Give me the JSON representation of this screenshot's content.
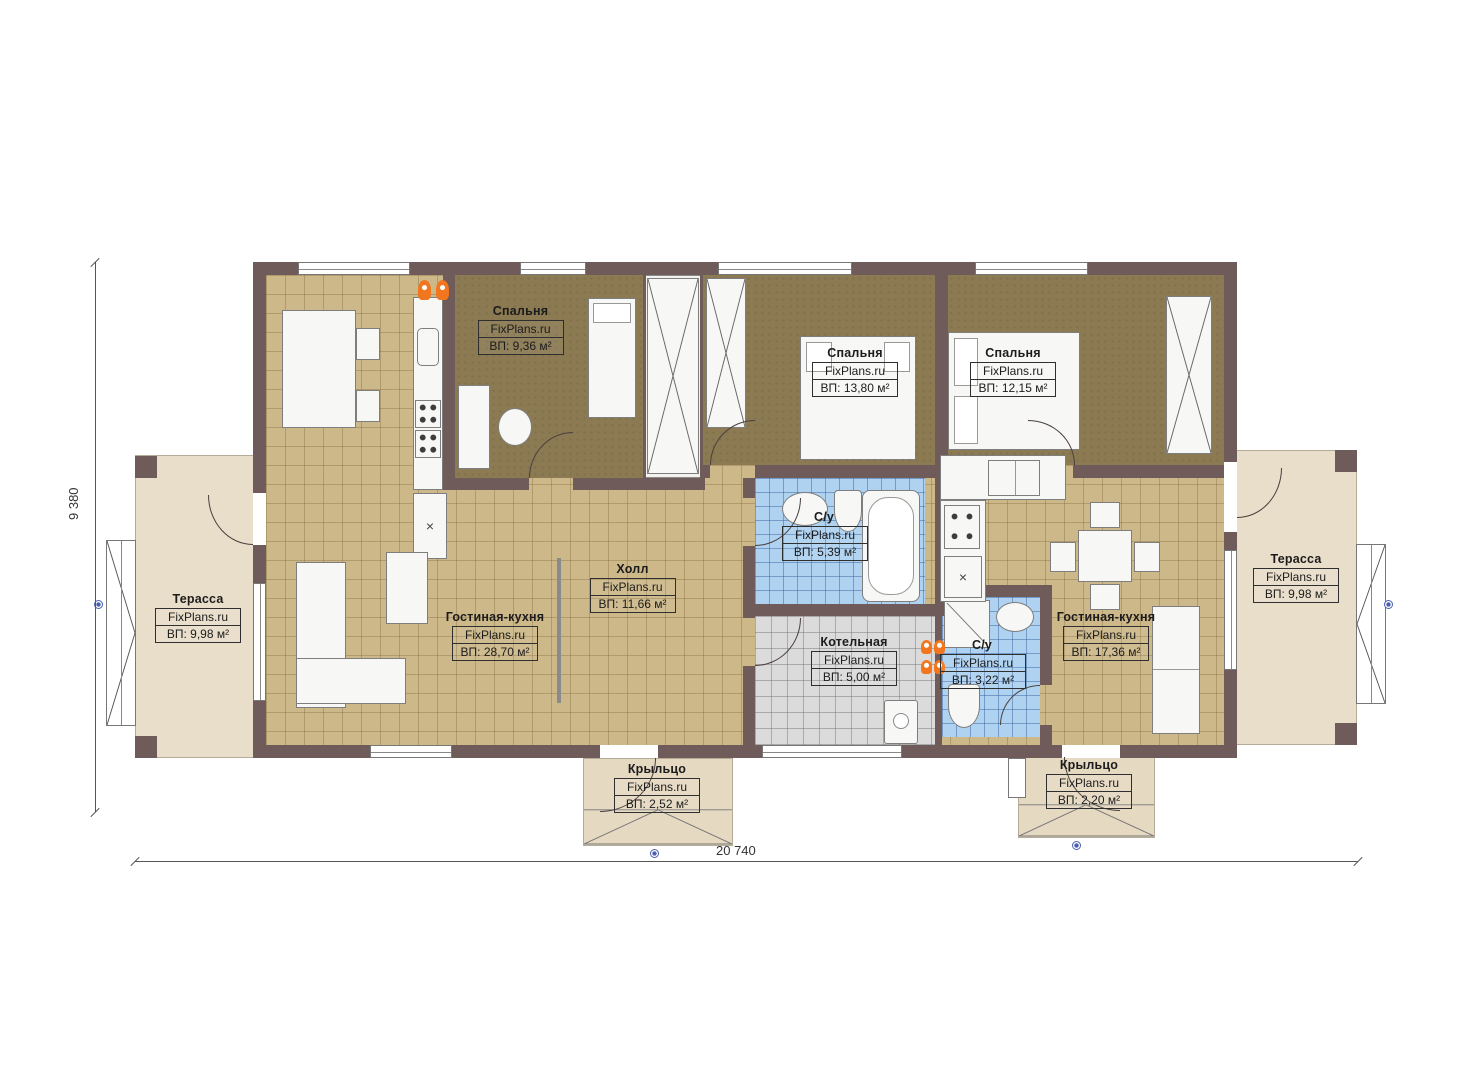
{
  "watermark": "FixPlans.ru",
  "plan": {
    "dimensions": {
      "width": "20 740",
      "height": "9 380"
    }
  },
  "colors": {
    "wall": "#6F5B59",
    "bedroom_floor": "#8B7A52",
    "tile_floor": "#CDB88A",
    "bath_floor": "#AFD2F0",
    "boiler_floor": "#DBDBDB",
    "terrace_floor": "#E9DEC9",
    "porch_floor": "#E6D9C2",
    "accent_orange": "#F2761D",
    "marker_blue": "#4A5FAE"
  },
  "rooms": [
    {
      "id": "bedroom-1",
      "name": "Спальня",
      "area": "ВП: 9,36 м²"
    },
    {
      "id": "bedroom-2",
      "name": "Спальня",
      "area": "ВП: 13,80 м²"
    },
    {
      "id": "bedroom-3",
      "name": "Спальня",
      "area": "ВП: 12,15 м²"
    },
    {
      "id": "bathroom-1",
      "name": "С/у",
      "area": "ВП: 5,39 м²"
    },
    {
      "id": "boiler-room",
      "name": "Котельная",
      "area": "ВП: 5,00 м²"
    },
    {
      "id": "bathroom-2",
      "name": "С/у",
      "area": "ВП: 3,22 м²"
    },
    {
      "id": "hall",
      "name": "Холл",
      "area": "ВП: 11,66 м²"
    },
    {
      "id": "living-kitchen-left",
      "name": "Гостиная-кухня",
      "area": "ВП: 28,70 м²"
    },
    {
      "id": "living-kitchen-right",
      "name": "Гостиная-кухня",
      "area": "ВП: 17,36 м²"
    },
    {
      "id": "terrace-left",
      "name": "Терасса",
      "area": "ВП: 9,98 м²"
    },
    {
      "id": "terrace-right",
      "name": "Терасса",
      "area": "ВП: 9,98 м²"
    },
    {
      "id": "porch-left",
      "name": "Крыльцо",
      "area": "ВП: 2,52 м²"
    },
    {
      "id": "porch-right",
      "name": "Крыльцо",
      "area": "ВП: 2,20 м²"
    }
  ]
}
